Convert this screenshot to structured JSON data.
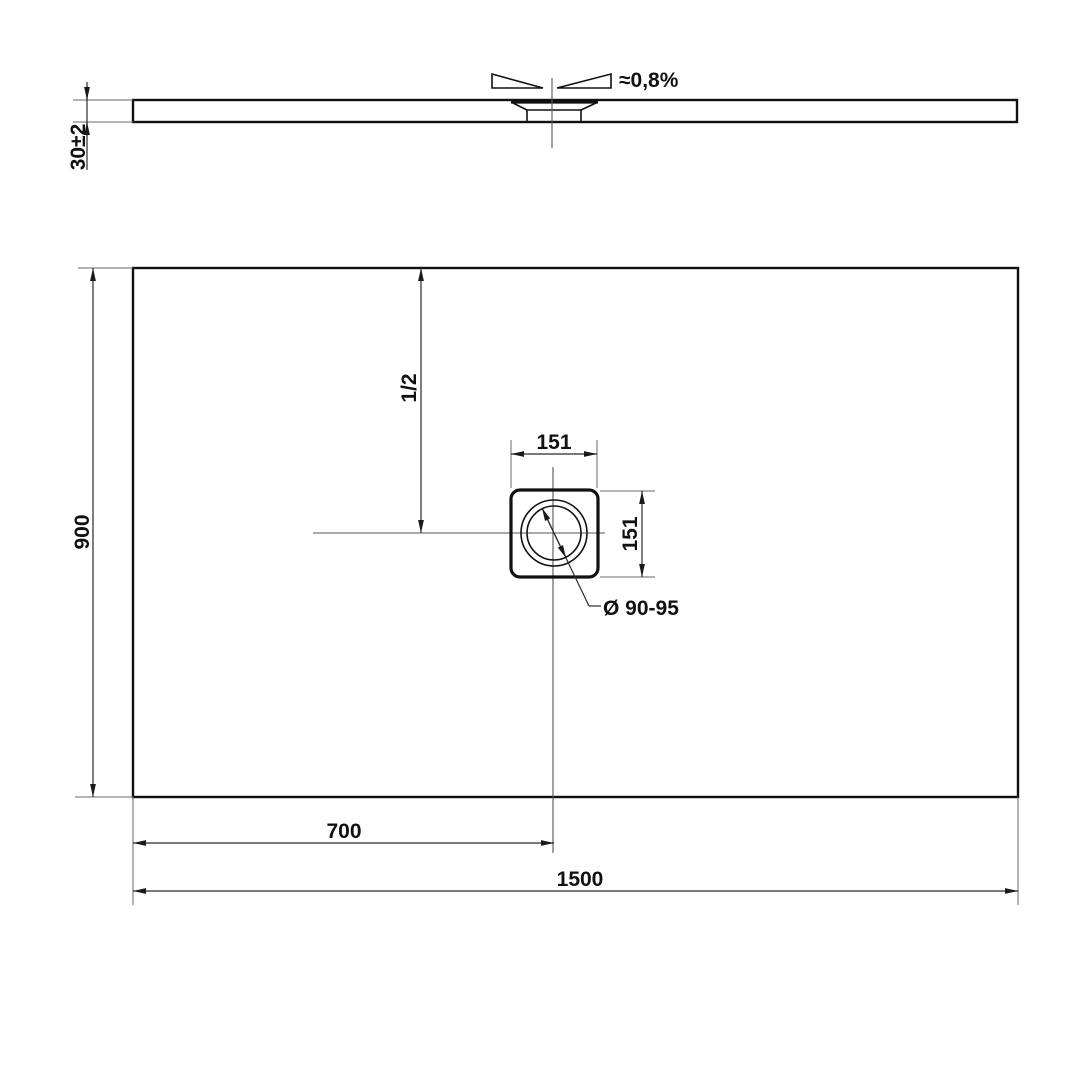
{
  "side_view": {
    "thickness_dim": "30±2",
    "slope_label": "≈0,8%"
  },
  "plan_view": {
    "height_dim": "900",
    "half_height_dim": "1/2",
    "drain_width_dim": "151",
    "drain_height_dim": "151",
    "drain_diameter_label": "Ø 90-95",
    "drain_center_from_left_dim": "700",
    "width_dim": "1500"
  }
}
